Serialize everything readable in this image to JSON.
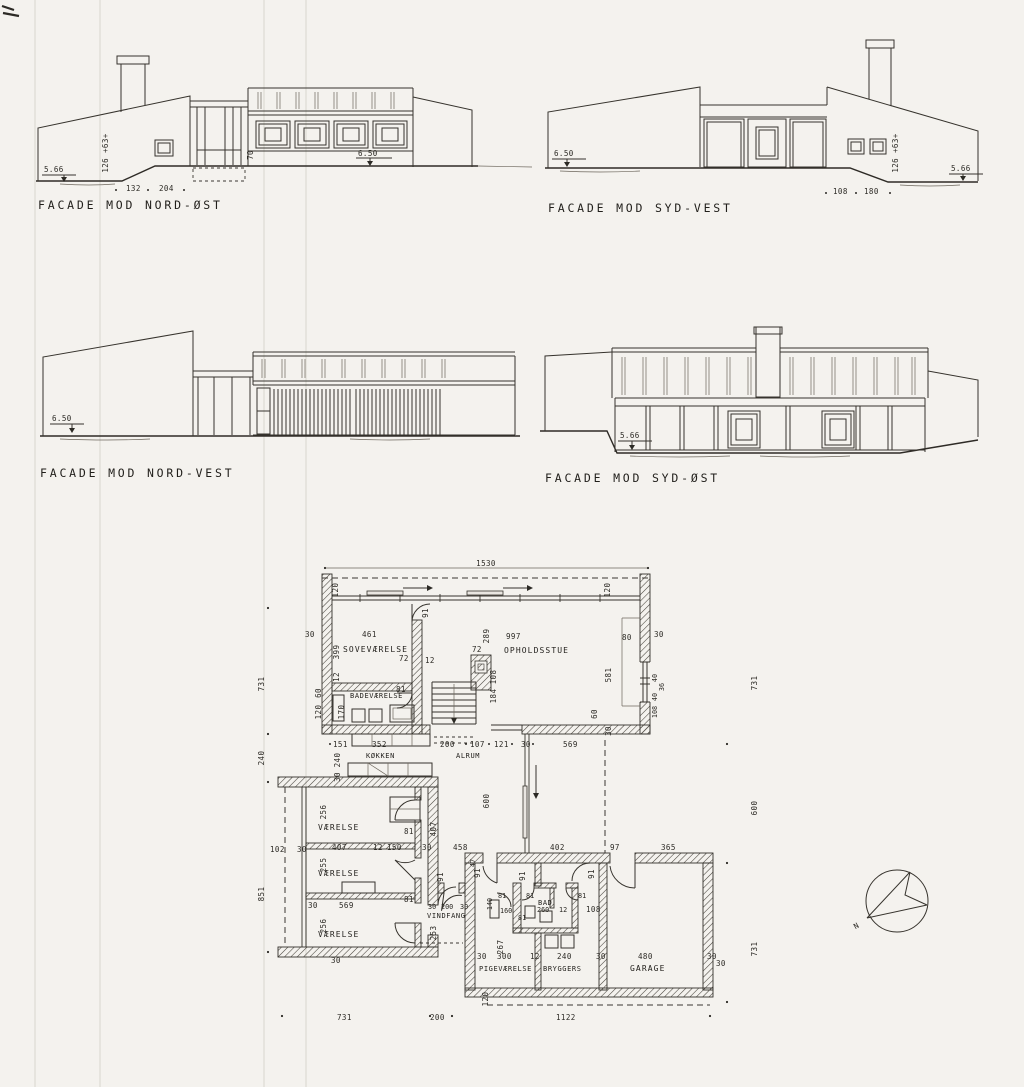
{
  "drawing": {
    "facades": {
      "nord_ost": {
        "label": "FACADE MOD NORD-ØST",
        "lvl_left": "5.66",
        "lvl_main": "6.50",
        "wall_h": "126 +63+",
        "win_h": "70",
        "base_a": "132",
        "base_b": "204"
      },
      "syd_vest": {
        "label": "FACADE MOD SYD-VEST",
        "lvl_left": "6.50",
        "lvl_right": "5.66",
        "wall_h": "126 +63+",
        "base_a": "108",
        "base_b": "180"
      },
      "nord_vest": {
        "label": "FACADE MOD NORD-VEST",
        "lvl": "6.50"
      },
      "syd_ost": {
        "label": "FACADE MOD SYD-ØST",
        "lvl": "5.66"
      }
    },
    "plan": {
      "rooms": {
        "sove": "SOVEVÆRELSE",
        "bade": "BADEVÆRELSE",
        "koekken": "KØKKEN",
        "alrum": "ALRUM",
        "opholdsstue": "OPHOLDSSTUE",
        "vaerelse": "VÆRELSE",
        "vindfang": "VINDFANG",
        "pige": "PIGEVÆRELSE",
        "bryggers": "BRYGGERS",
        "bad": "BAD",
        "garage": "GARAGE"
      },
      "dims": {
        "d12": "12",
        "d30": "30",
        "d36": "36",
        "d40": "40",
        "d47": "47",
        "d60": "60",
        "d72": "72",
        "d80": "80",
        "d81": "81",
        "d91": "91",
        "d97": "97",
        "d102": "102",
        "d107": "107",
        "d108": "108",
        "d120": "120",
        "d121": "121",
        "d140": "140",
        "d150": "150",
        "d151": "151",
        "d160": "160",
        "d170": "170",
        "d184": "184",
        "d200": "200",
        "d240": "240",
        "d253": "253",
        "d255": "255",
        "d256": "256",
        "d260": "260",
        "d267": "267",
        "d289": "289",
        "d300": "300",
        "d352": "352",
        "d365": "365",
        "d399": "399",
        "d402": "402",
        "d407": "407",
        "d458": "458",
        "d461": "461",
        "d480": "480",
        "d569": "569",
        "d581": "581",
        "d600": "600",
        "d731": "731",
        "d851": "851",
        "d997": "997",
        "d1122": "1122",
        "d1530": "1530"
      }
    },
    "compass": {
      "n": "N"
    }
  }
}
